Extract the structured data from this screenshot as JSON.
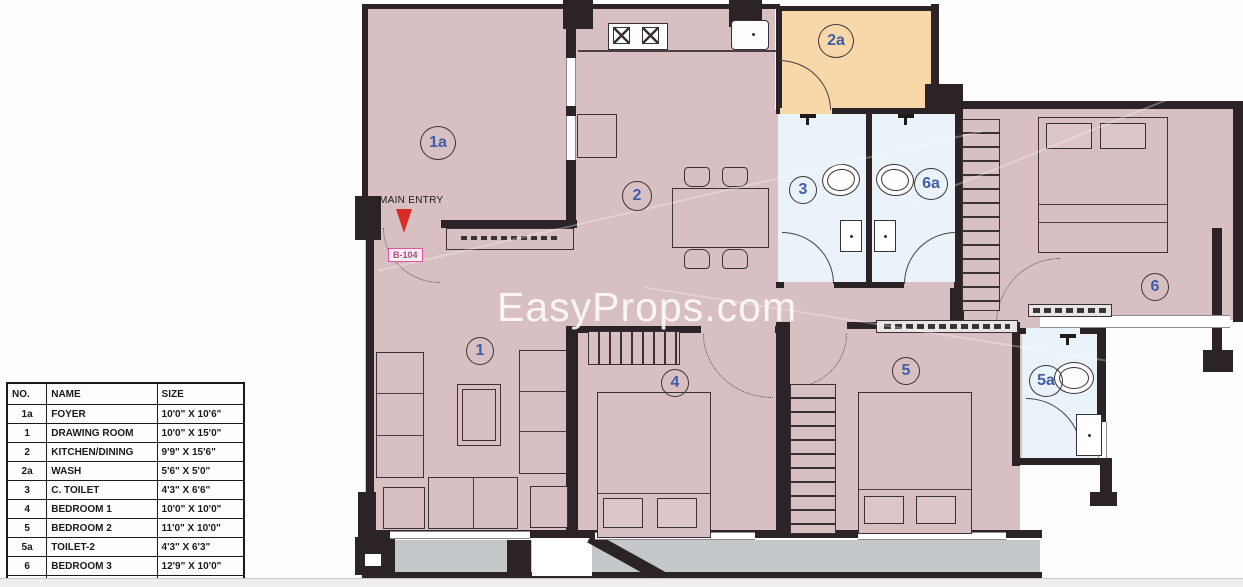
{
  "watermark": "EasyProps.com",
  "plan": {
    "entry_label": "MAIN ENTRY",
    "unit_label": "B-104",
    "room_labels": [
      "1a",
      "2",
      "2a",
      "3",
      "6a",
      "6",
      "1",
      "4",
      "5",
      "5a"
    ]
  },
  "legend_table": {
    "headers": [
      "NO.",
      "NAME",
      "SIZE"
    ],
    "rows": [
      [
        "1a",
        "FOYER",
        "10'0\" X 10'6\""
      ],
      [
        "1",
        "DRAWING ROOM",
        "10'0\" X 15'0\""
      ],
      [
        "2",
        "KITCHEN/DINING",
        "9'9\" X 15'6\""
      ],
      [
        "2a",
        "WASH",
        "5'6\" X 5'0\""
      ],
      [
        "3",
        "C. TOILET",
        "4'3\" X 6'6\""
      ],
      [
        "4",
        "BEDROOM 1",
        "10'0\" X 10'0\""
      ],
      [
        "5",
        "BEDROOM 2",
        "11'0\" X 10'0\""
      ],
      [
        "5a",
        "TOILET-2",
        "4'3\" X 6'3\""
      ],
      [
        "6",
        "BEDROOM 3",
        "12'9\" X 10'0\""
      ],
      [
        "6a",
        "TOILET-3",
        "4'3\" X 6'6\""
      ]
    ]
  },
  "colors": {
    "room_fill": "#d8bfc1",
    "wash_fill": "#f8d8a8",
    "toilet_fill": "#e9f3f9",
    "balcony_fill": "#c4c8cb",
    "wall": "#2b2326",
    "label_blue": "#3f5da8",
    "entry_arrow_red": "#d92b27",
    "unit_label_pink": "#e0559d"
  }
}
